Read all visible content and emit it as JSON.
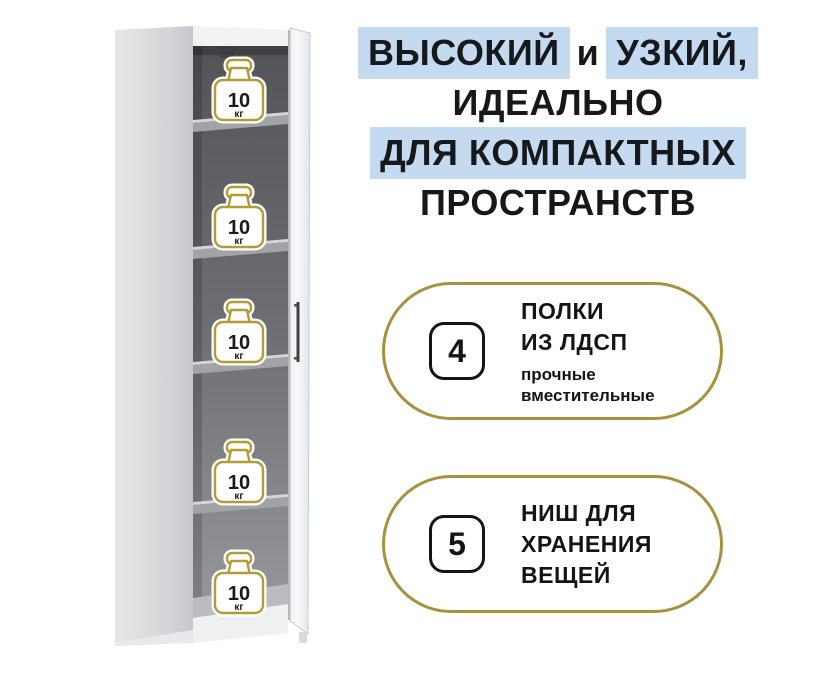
{
  "headline": {
    "line1_part1": "ВЫСОКИЙ",
    "line1_part2": "и",
    "line1_part3": "УЗКИЙ,",
    "line2": "ИДЕАЛЬНО",
    "line3": "ДЛЯ КОМПАКТНЫХ",
    "line4": "ПРОСТРАНСТВ",
    "highlight_color": "#c4daf0",
    "text_color": "#17181a"
  },
  "features": [
    {
      "number": "4",
      "title_line1": "ПОЛКИ",
      "title_line2": "ИЗ ЛДСП",
      "subtitle_line1": "прочные",
      "subtitle_line2": "вместительные"
    },
    {
      "number": "5",
      "title_line1": "НИШ ДЛЯ",
      "title_line2": "ХРАНЕНИЯ",
      "title_line3": "ВЕЩЕЙ"
    }
  ],
  "cabinet": {
    "niche_count": 5,
    "weight_value": "10",
    "weight_unit": "кг",
    "accent_gold": "#b49a38"
  }
}
